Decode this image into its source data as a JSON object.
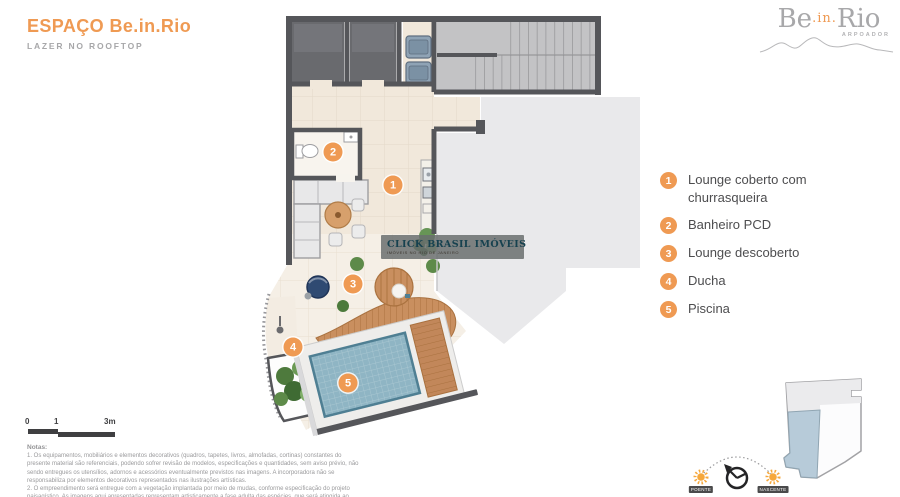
{
  "header": {
    "title": "ESPAÇO Be.in.Rio",
    "subtitle": "LAZER NO ROOFTOP"
  },
  "logo": {
    "be": "Be",
    "in": ".in.",
    "rio": "Rio",
    "tag": "ARPOADOR"
  },
  "legend": {
    "items": [
      {
        "num": "1",
        "label": "Lounge coberto com churrasqueira"
      },
      {
        "num": "2",
        "label": "Banheiro PCD"
      },
      {
        "num": "3",
        "label": "Lounge descoberto"
      },
      {
        "num": "4",
        "label": "Ducha"
      },
      {
        "num": "5",
        "label": "Piscina"
      }
    ]
  },
  "markers": [
    {
      "num": "1"
    },
    {
      "num": "2"
    },
    {
      "num": "3"
    },
    {
      "num": "4"
    },
    {
      "num": "5"
    }
  ],
  "watermark": {
    "name": "CLICK BRASIL IMÓVEIS",
    "tagline": "IMÓVEIS NO RIO DE JANEIRO"
  },
  "scale": {
    "t0": "0",
    "t1": "1",
    "t2": "3m"
  },
  "sun": {
    "west": "POENTE",
    "east": "NASCENTE"
  },
  "notes": {
    "heading": "Notas:",
    "items": [
      "1. Os equipamentos, mobiliários e elementos decorativos (quadros, tapetes, livros, almofadas, cortinas) constantes do presente material são referenciais, podendo sofrer revisão de modelos, especificações e quantidades, sem aviso prévio, não sendo entregues os utensílios, adornos e acessórios eventualmente previstos nas imagens. A incorporadora não se responsabiliza por elementos decorativos representados nas ilustrações artísticas.",
      "2. O empreendimento será entregue com a vegetação implantada por meio de mudas, conforme especificação do projeto paisagístico. As imagens aqui apresentadas representam artisticamente a fase adulta das espécies, que será atingida ao longo do tempo."
    ]
  },
  "colors": {
    "accent": "#ef9a53",
    "wall": "#55565a",
    "floor_tile": "#f1e8db",
    "roof_slab": "#e9e9eb",
    "pool": "#8fb5c4",
    "wood_deck": "#c2875a",
    "keyplan_highlight": "#b7cbd9"
  }
}
